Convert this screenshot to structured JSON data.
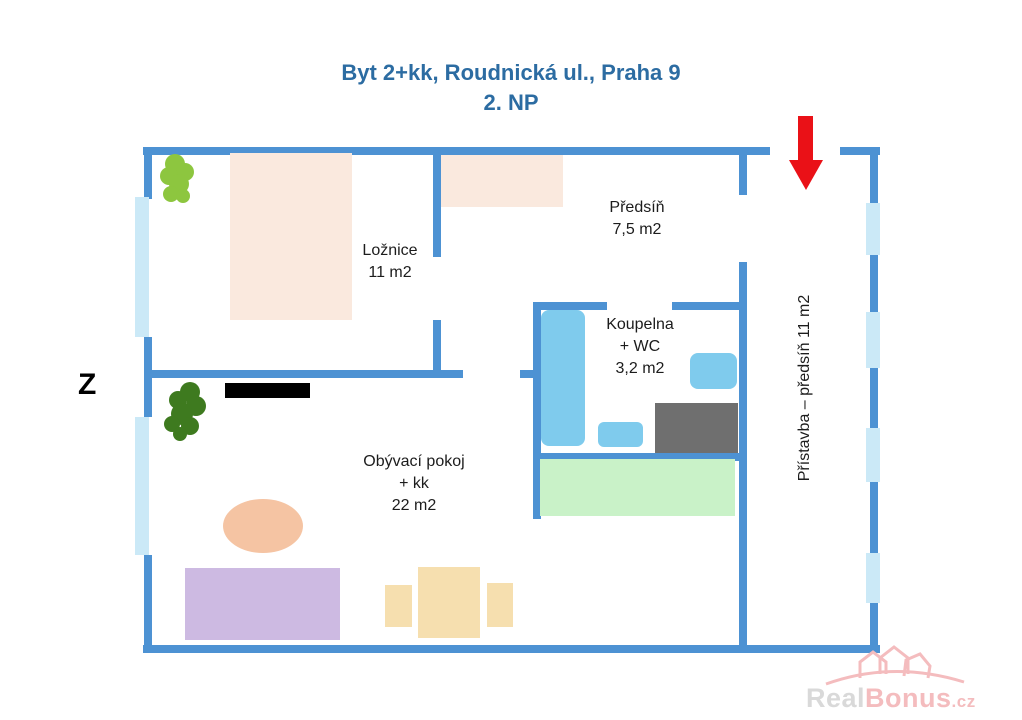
{
  "title": {
    "line1": "Byt 2+kk, Roudnická ul., Praha 9",
    "line2": "2. NP"
  },
  "compass": {
    "west": "Z"
  },
  "rooms": {
    "loznice": {
      "name": "Ložnice",
      "area": "11 m2"
    },
    "predsin": {
      "name": "Předsíň",
      "area": "7,5 m2"
    },
    "koupelna": {
      "name": "Koupelna",
      "line2": "+ WC",
      "area": "3,2 m2"
    },
    "obyvaci": {
      "name": "Obývací pokoj",
      "line2": "+ kk",
      "area": "22 m2"
    },
    "pristavba": {
      "label": "Přístavba – předsíň 11 m2"
    }
  },
  "watermark": {
    "part1": "Real",
    "part2": "Bonus",
    "suffix": ".cz"
  },
  "colors": {
    "wall": "#4d92d3",
    "window": "#cbe9f7",
    "title_blue": "#2c6ca2",
    "arrow_red": "#ea1117",
    "fixture_blue": "#7fcbed",
    "furniture_peach": "#fae9de",
    "sofa_purple": "#cdbae2",
    "table_tan": "#f6dfaf",
    "counter_green": "#c9f2c8",
    "appliance_gray": "#6f6f6f",
    "coffee_table_salmon": "#f5c4a3",
    "tree_light_green": "#8dc63f",
    "tree_dark_green": "#3e7a1f",
    "watermark_gray": "#d9d9d9",
    "watermark_pink": "#f4bcbe"
  }
}
